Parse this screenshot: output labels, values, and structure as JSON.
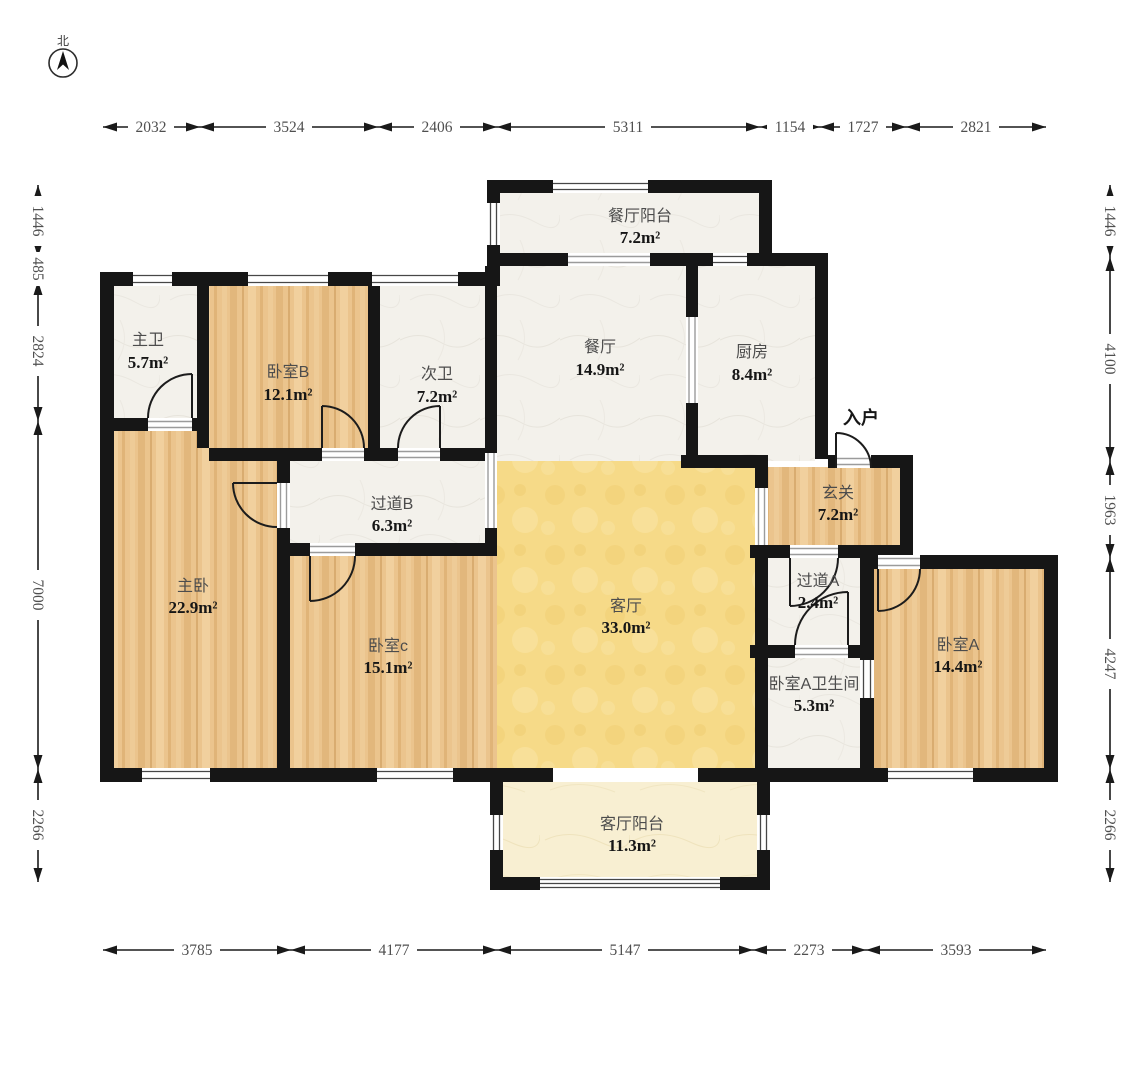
{
  "compass": {
    "north_label": "北"
  },
  "entry": {
    "label": "入户"
  },
  "rooms": {
    "dining_balcony": {
      "name": "餐厅阳台",
      "area": "7.2m²"
    },
    "master_bath": {
      "name": "主卫",
      "area": "5.7m²"
    },
    "bedroom_b": {
      "name": "卧室B",
      "area": "12.1m²"
    },
    "second_bath": {
      "name": "次卫",
      "area": "7.2m²"
    },
    "dining": {
      "name": "餐厅",
      "area": "14.9m²"
    },
    "kitchen": {
      "name": "厨房",
      "area": "8.4m²"
    },
    "foyer": {
      "name": "玄关",
      "area": "7.2m²"
    },
    "corridor_b": {
      "name": "过道B",
      "area": "6.3m²"
    },
    "master_bedroom": {
      "name": "主卧",
      "area": "22.9m²"
    },
    "living": {
      "name": "客厅",
      "area": "33.0m²"
    },
    "corridor_a": {
      "name": "过道A",
      "area": "2.4m²"
    },
    "bedroom_c": {
      "name": "卧室c",
      "area": "15.1m²"
    },
    "bedroom_a": {
      "name": "卧室A",
      "area": "14.4m²"
    },
    "bedroom_a_bath": {
      "name": "卧室A卫生间",
      "area": "5.3m²"
    },
    "living_balcony": {
      "name": "客厅阳台",
      "area": "11.3m²"
    }
  },
  "dimensions": {
    "top": [
      "2032",
      "3524",
      "2406",
      "5311",
      "1154",
      "1727",
      "2821"
    ],
    "bottom": [
      "3785",
      "4177",
      "5147",
      "2273",
      "3593"
    ],
    "left": [
      "1446",
      "485",
      "2824",
      "7000",
      "2266"
    ],
    "right": [
      "1446",
      "4100",
      "1963",
      "4247",
      "2266"
    ]
  },
  "colors": {
    "wall": "#161616",
    "wood_floor": "#ebc48d",
    "living_floor": "#f6da88",
    "balcony_floor": "#f8efd2",
    "tile_floor": "#f3f1eb"
  }
}
